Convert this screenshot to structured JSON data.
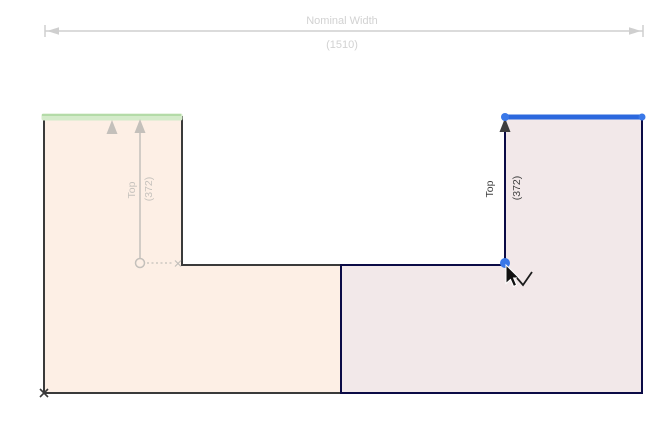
{
  "drawing": {
    "nominal_width": {
      "label": "Nominal Width",
      "value": "(1510)"
    },
    "left_top_dim": {
      "label": "Top",
      "value": "(372)"
    },
    "right_top_dim": {
      "label": "Top",
      "value": "(372)"
    }
  },
  "colors": {
    "left_panel_fill": "#fdefe5",
    "left_panel_stroke": "#3a3a3a",
    "right_panel_fill": "#f2e8e9",
    "right_panel_stroke": "#0b0b46",
    "selected_edge_blue": "#2c68de",
    "selected_vertex_blue": "#3a78e8",
    "highlight_edge_green_band": "#d4ebca",
    "highlight_edge_green_line": "#b4dba8",
    "dim_inactive_gray": "#c4c0bb",
    "dim_active_arrow": "#3d3d3d",
    "nominal_dim_gray": "#cfcfcf",
    "origin_marker": "#3a3a3a"
  }
}
